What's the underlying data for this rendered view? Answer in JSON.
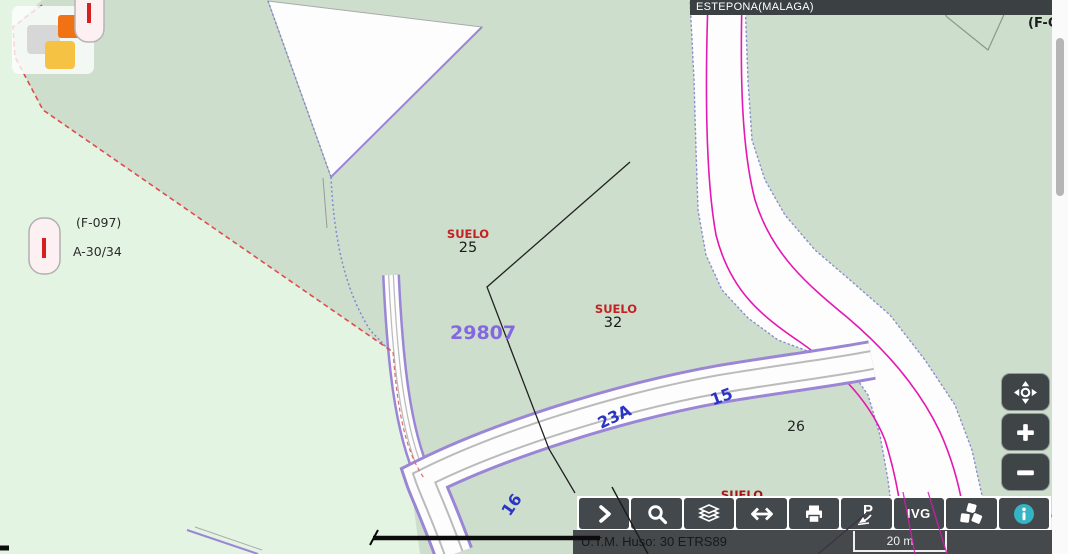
{
  "banner": {
    "text": "ESTEPONA(MALAGA)"
  },
  "map": {
    "parcel_labels": {
      "suelo_25_type": "SUELO",
      "suelo_25_num": "25",
      "suelo_32_type": "SUELO",
      "suelo_32_num": "32",
      "suelo_bottom_type": "SUELO",
      "cadastral_code": "29807",
      "parcel_26": "26"
    },
    "road_labels": {
      "r23a": "23A",
      "r15": "15",
      "r16": "16"
    },
    "annotations": {
      "f097": "(F-097)",
      "a3034": "A-30/34",
      "fc_truncated": "(F-C"
    }
  },
  "toolbar": {
    "buttons": [
      {
        "name": "expand",
        "icon": "chevron-right"
      },
      {
        "name": "search",
        "icon": "magnifier"
      },
      {
        "name": "layers",
        "icon": "layers"
      },
      {
        "name": "measure",
        "icon": "double-arrow"
      },
      {
        "name": "print",
        "icon": "printer"
      },
      {
        "name": "pegman",
        "icon": "p-arrow",
        "label": "P"
      },
      {
        "name": "ivg",
        "icon": "text",
        "label": "IVG"
      },
      {
        "name": "cubes",
        "icon": "cubes"
      },
      {
        "name": "info",
        "icon": "info-circle"
      }
    ]
  },
  "zoom_controls": {
    "pan": "pan",
    "zoom_in": "+",
    "zoom_out": "−"
  },
  "status_bar": {
    "projection": "U.T.M. Huso: 30 ETRS89",
    "scale_label": "20 m"
  },
  "colors": {
    "land_light": "#e4f4e2",
    "land_gray": "#cedecd",
    "road_edge_violet": "#9b86d6",
    "boundary_magenta": "#e418b2",
    "boundary_red": "#e04b4b",
    "label_red": "#c42222",
    "label_blue": "#2a35c8",
    "code_purple": "#8468e0",
    "ui_dark": "#42484b",
    "info_teal": "#35b4c4"
  }
}
